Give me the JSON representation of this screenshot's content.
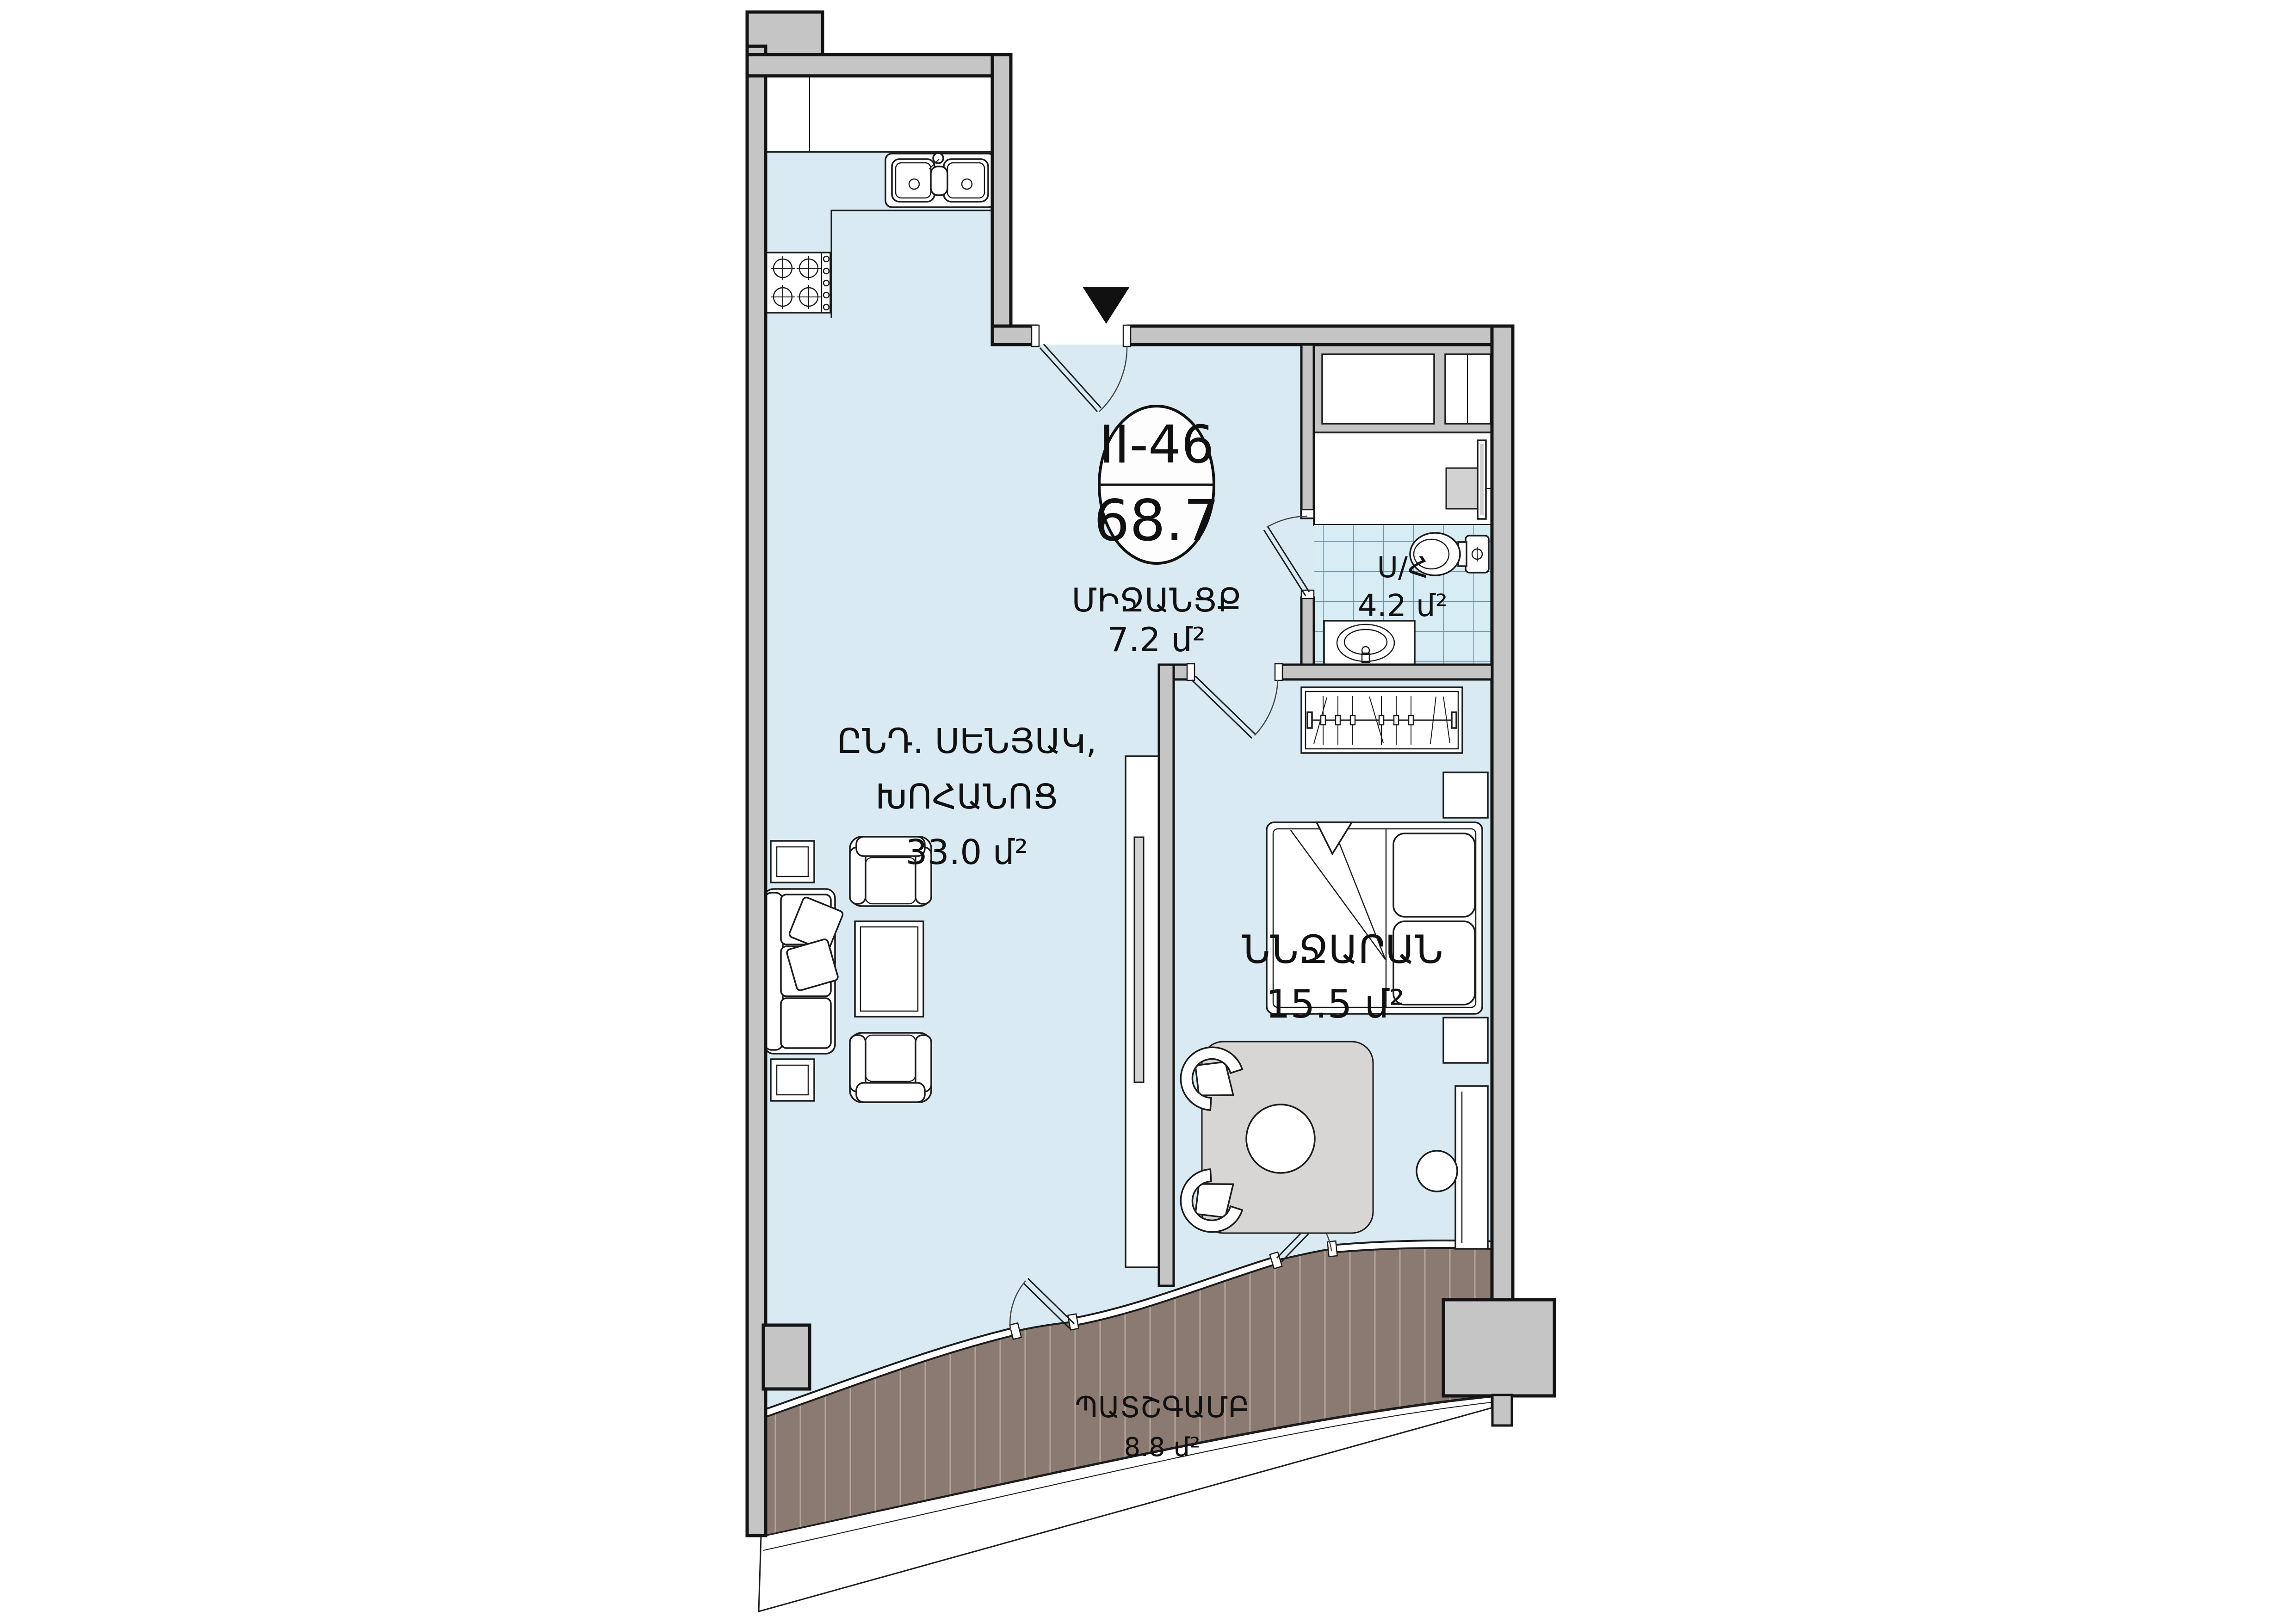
{
  "plan": {
    "unit": {
      "id": "II-46",
      "total_area": "68.7"
    },
    "rooms": [
      {
        "key": "corridor",
        "name": "ՄԻՋԱՆՑՔ",
        "area": "7.2 մ²"
      },
      {
        "key": "bathroom",
        "name": "Ս/Հ",
        "area": "4.2 մ²"
      },
      {
        "key": "living_kitchen",
        "name_line1": "ԸՆԴ. ՍԵՆՅԱԿ,",
        "name_line2": "ԽՈՀԱՆՈՑ",
        "area": "33.0 մ²"
      },
      {
        "key": "bedroom",
        "name": "ՆՆՋԱՐԱՆ",
        "area": "15.5 մ²"
      },
      {
        "key": "balcony",
        "name": "ՊԱՏՇԳԱՄԲ",
        "area": "8.8 մ²"
      }
    ],
    "colors": {
      "floor": "#d9eaf2",
      "wall_fill": "#c5c5c5",
      "wall_stroke": "#141414",
      "deck": "#8b7a71",
      "deck_stripe": "#b3a69d",
      "tile_bg": "#d8ecf4",
      "tile_line": "#6b8fa5",
      "rug": "#d8d6d4",
      "fixture_gray": "#d2d2d2",
      "label": "#111111"
    }
  }
}
